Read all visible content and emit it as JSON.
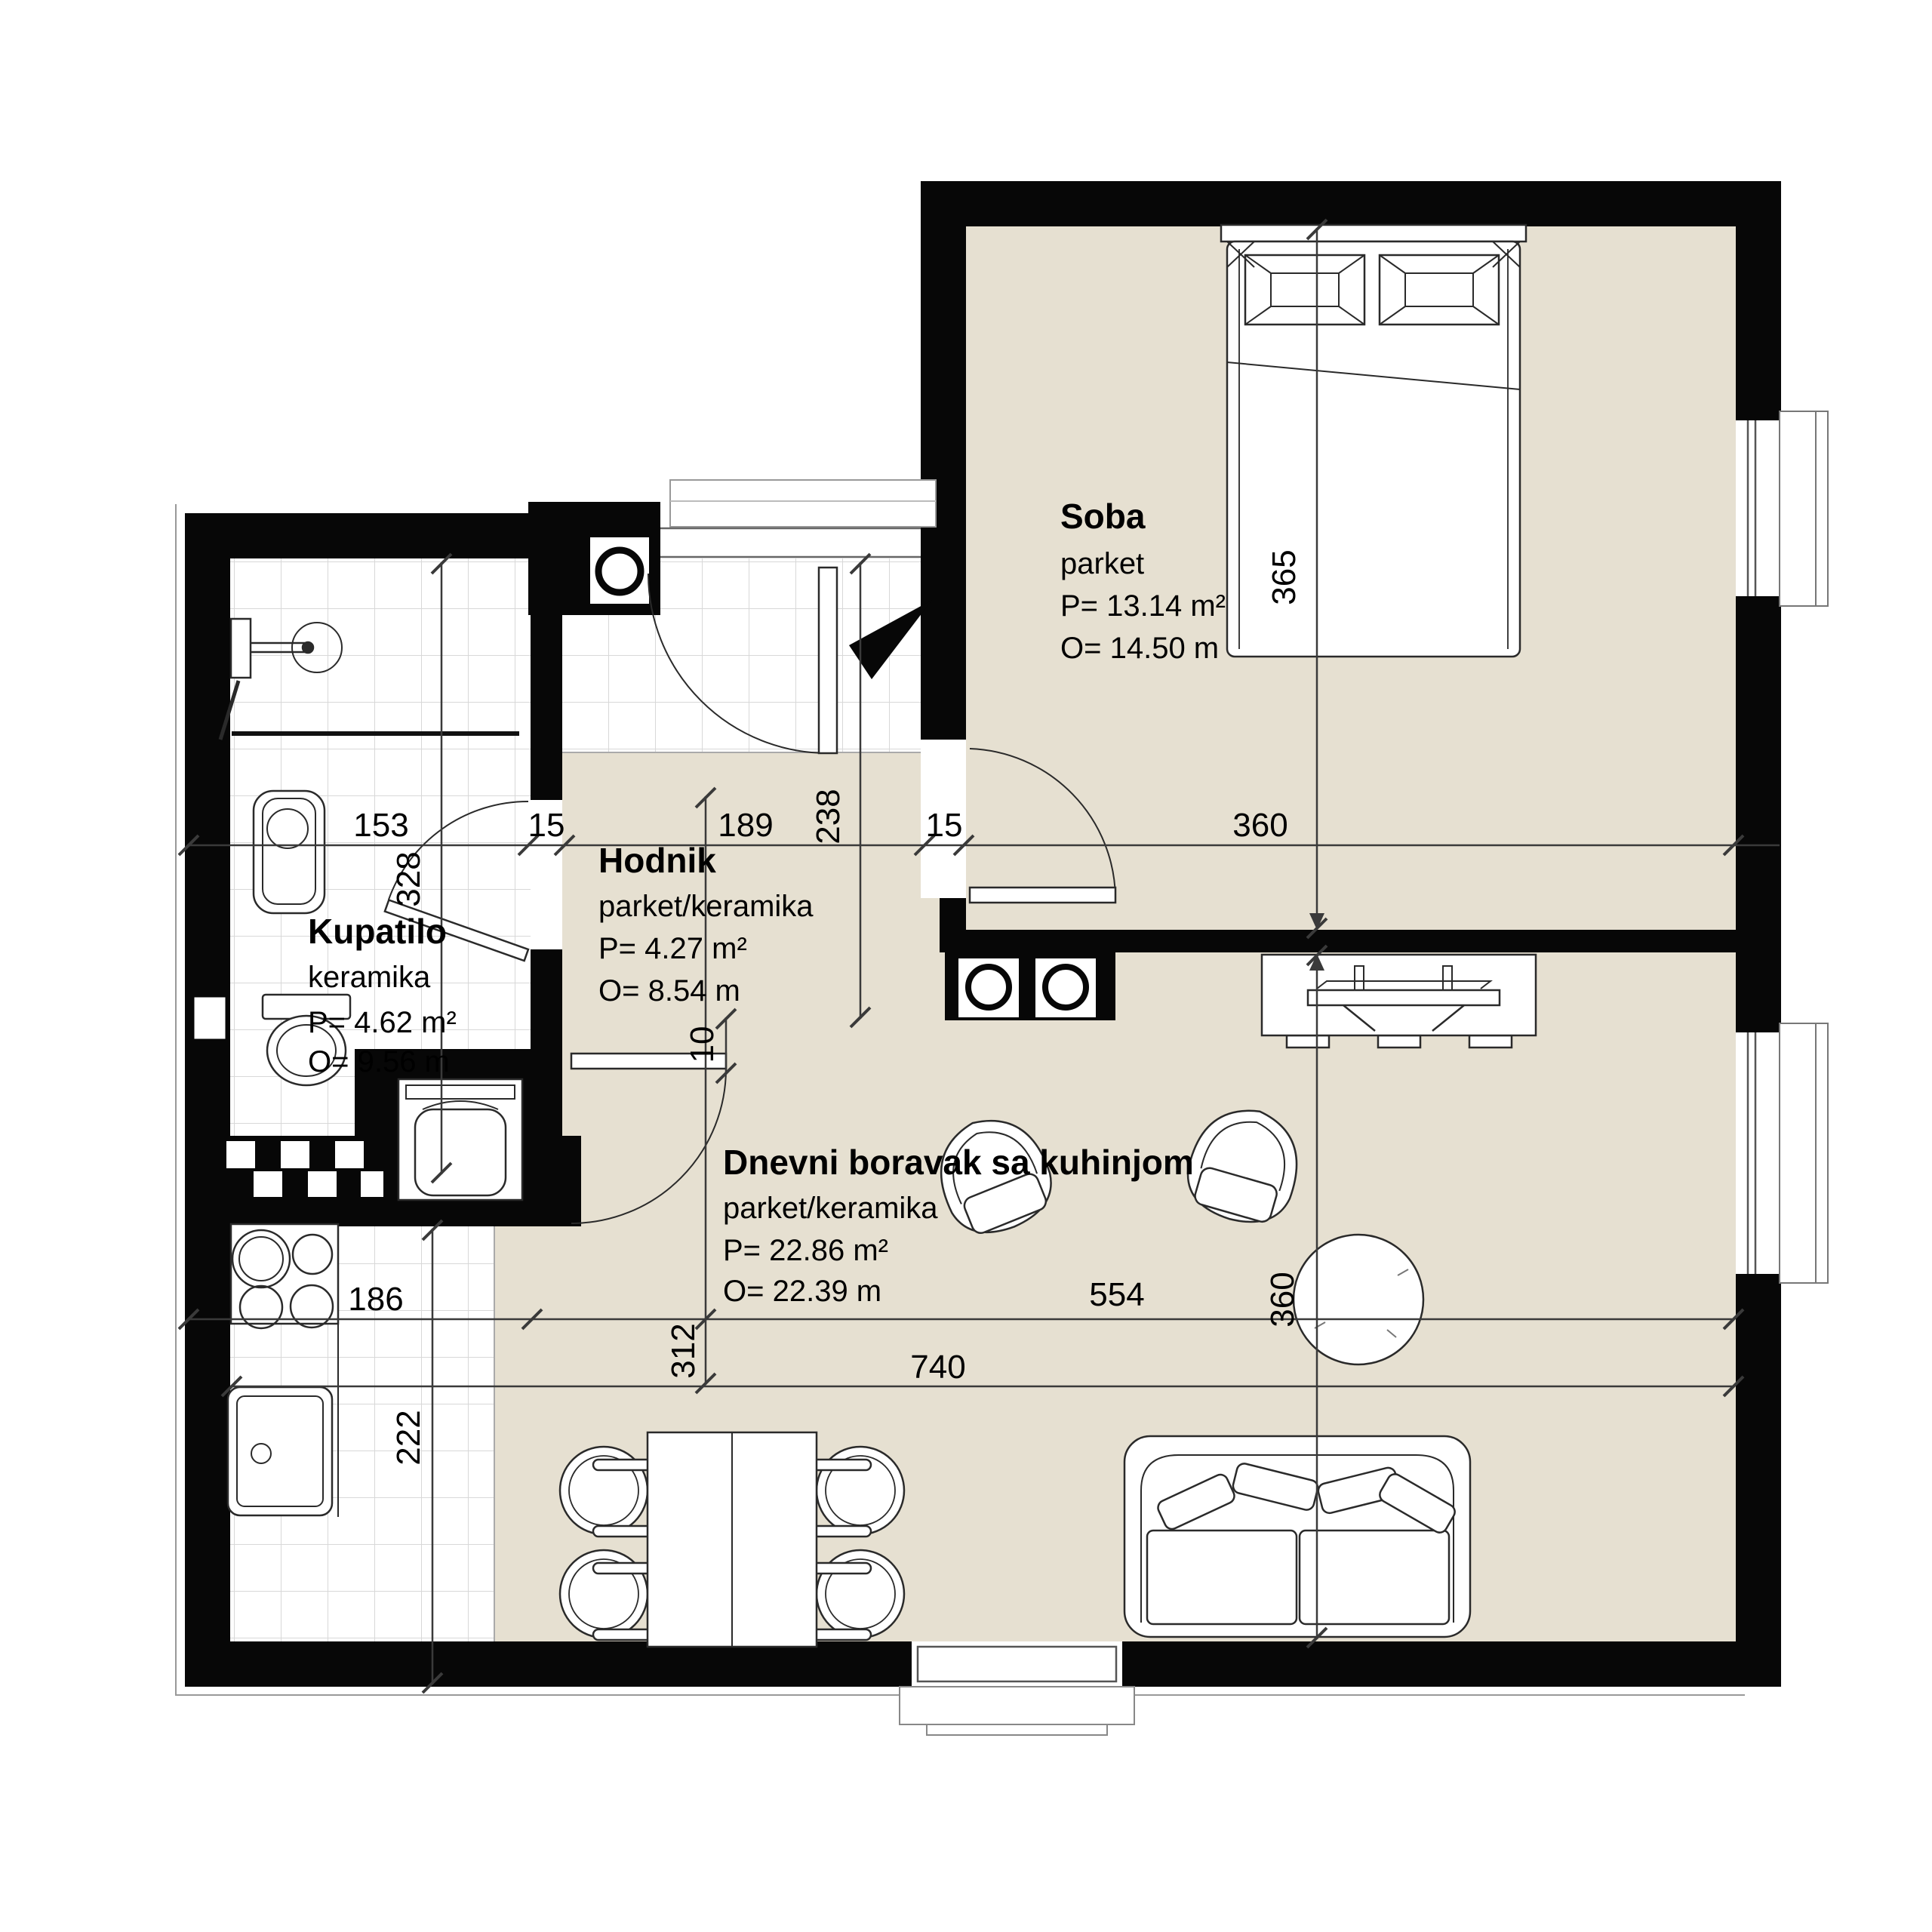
{
  "plan_title": "Apartment floor plan",
  "colors": {
    "wall": "#070707",
    "floor_beige": "#e6e0d1",
    "tile_line": "#d8d8d8",
    "furniture_line": "#2a2a2a",
    "dim_line": "#3a3a3a"
  },
  "rooms": {
    "soba": {
      "name": "Soba",
      "floor": "parket",
      "area": "P= 13.14 m²",
      "perimeter": "O= 14.50 m"
    },
    "hodnik": {
      "name": "Hodnik",
      "floor": "parket/keramika",
      "area": "P= 4.27 m²",
      "perimeter": "O= 8.54 m"
    },
    "kupatilo": {
      "name": "Kupatilo",
      "floor": "keramika",
      "area": "P= 4.62 m²",
      "perimeter": "O= 9.56 m"
    },
    "dnevni": {
      "name": "Dnevni boravak sa kuhinjom",
      "floor": "parket/keramika",
      "area": "P= 22.86 m²",
      "perimeter": "O= 22.39 m"
    }
  },
  "dimensions": {
    "d153": "153",
    "d15a": "15",
    "d189": "189",
    "d15b": "15",
    "d360a": "360",
    "d328": "328",
    "d238": "238",
    "d365": "365",
    "d186": "186",
    "d222": "222",
    "d312": "312",
    "d554": "554",
    "d360b": "360",
    "d740": "740",
    "d10": "10"
  }
}
